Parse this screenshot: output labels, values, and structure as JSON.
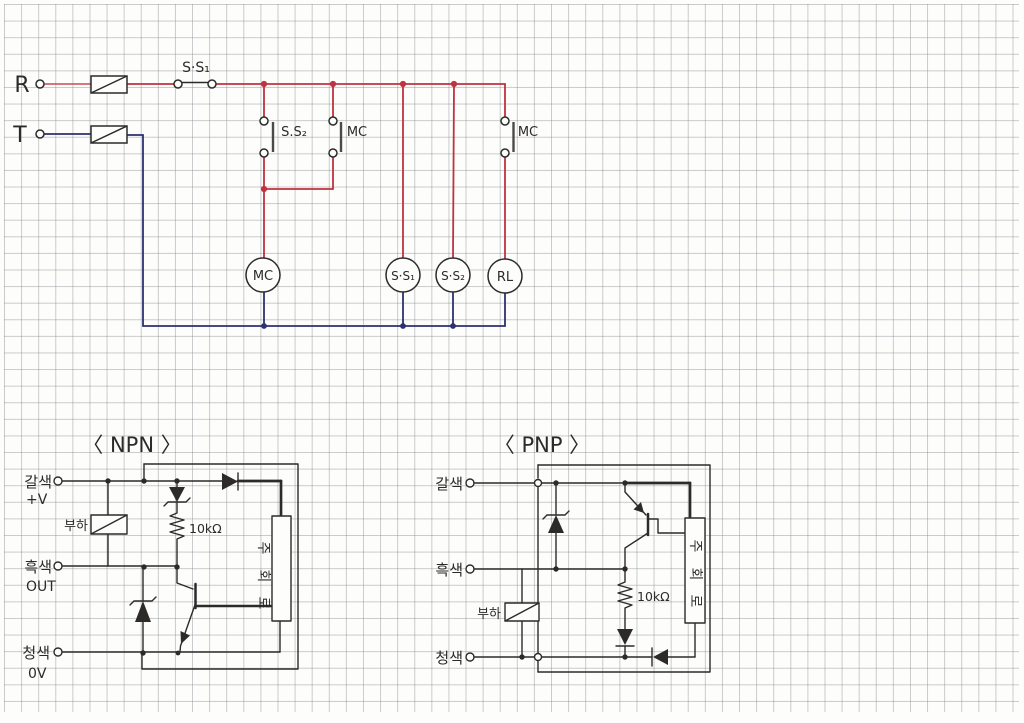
{
  "relay_circuit": {
    "supply_r_label": "R",
    "supply_t_label": "T",
    "main_switch_label": "S·S₁",
    "aux_switch_label": "S.S₂",
    "holding_contact_label": "MC",
    "rl_branch_contact_label": "MC",
    "coil_mc_label": "MC",
    "coil_ss1_label": "S·S₁",
    "coil_ss2_label": "S·S₂",
    "coil_rl_label": "RL"
  },
  "npn": {
    "title": "〈 NPN 〉",
    "terminal_brown_label": "갈색",
    "terminal_brown_sub": "+V",
    "terminal_black_label": "흑색",
    "terminal_black_sub": "OUT",
    "terminal_blue_label": "청색",
    "terminal_blue_sub": "0V",
    "load_label": "부하",
    "resistor_label": "10kΩ",
    "main_circuit_chars": [
      "주",
      "회",
      "로"
    ]
  },
  "pnp": {
    "title": "〈 PNP 〉",
    "terminal_brown_label": "갈색",
    "terminal_black_label": "흑색",
    "terminal_blue_label": "청색",
    "load_label": "부하",
    "resistor_label": "10kΩ",
    "main_circuit_chars": [
      "주",
      "회",
      "로"
    ]
  },
  "colors": {
    "wire_red": "#bf3240",
    "wire_blue": "#2d3170",
    "ink": "#2d2b2a",
    "contact_bar": "#4c4a48"
  }
}
